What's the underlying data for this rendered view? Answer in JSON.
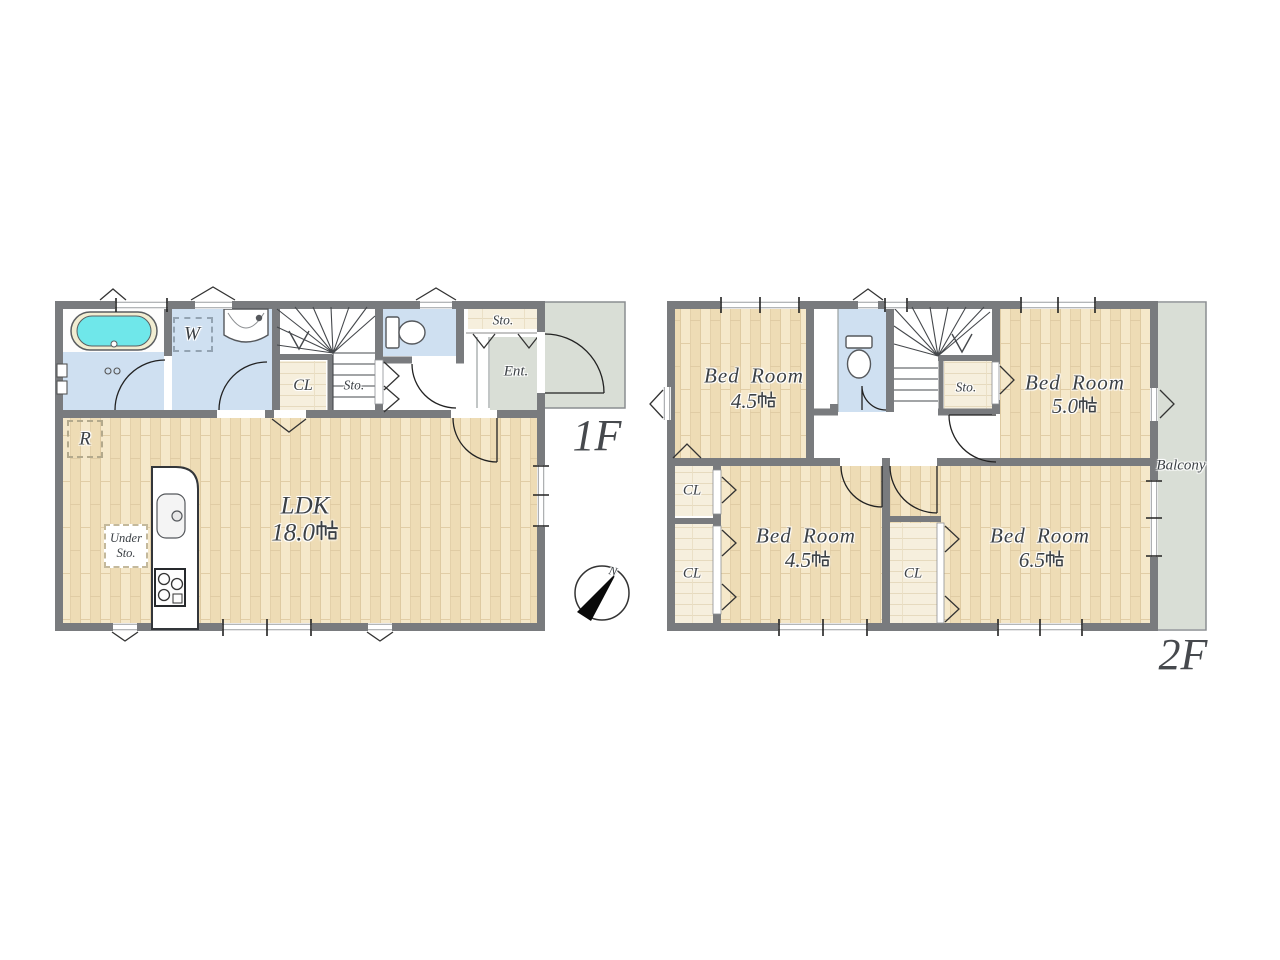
{
  "floor1": {
    "floor_label": "1F",
    "ldk": {
      "name": "LDK",
      "area_label": "18.0帖",
      "area_value": "18.0"
    },
    "washroom_label": "W",
    "closet_label": "CL",
    "understair_storage_label": "Sto.",
    "entry_storage_label": "Sto.",
    "entrance_label": "Ent.",
    "refrigerator_label": "R",
    "under_floor_storage": {
      "line1": "Under",
      "line2": "Sto."
    }
  },
  "floor2": {
    "floor_label": "2F",
    "bedroom_nw": {
      "name": "Bed Room",
      "area_label": "4.5帖",
      "area_value": "4.5"
    },
    "bedroom_ne": {
      "name": "Bed Room",
      "area_label": "5.0帖",
      "area_value": "5.0"
    },
    "bedroom_sw": {
      "name": "Bed Room",
      "area_label": "4.5帖",
      "area_value": "4.5"
    },
    "bedroom_se": {
      "name": "Bed Room",
      "area_label": "6.5帖",
      "area_value": "6.5"
    },
    "storage_label": "Sto.",
    "closet_nw_label": "CL",
    "closet_sw_label": "CL",
    "closet_mid_label": "CL",
    "balcony_label": "Balcony"
  },
  "compass": {
    "north_label": "N"
  },
  "colors": {
    "wall": "#797b7e",
    "wood_floor": "#f5e8ca",
    "water_room": "#cfe0f1",
    "tile": "#d9ded6",
    "bathtub": "#6fe7ea",
    "closet_floor": "#f6efdd",
    "label_text": "#3c4146"
  }
}
